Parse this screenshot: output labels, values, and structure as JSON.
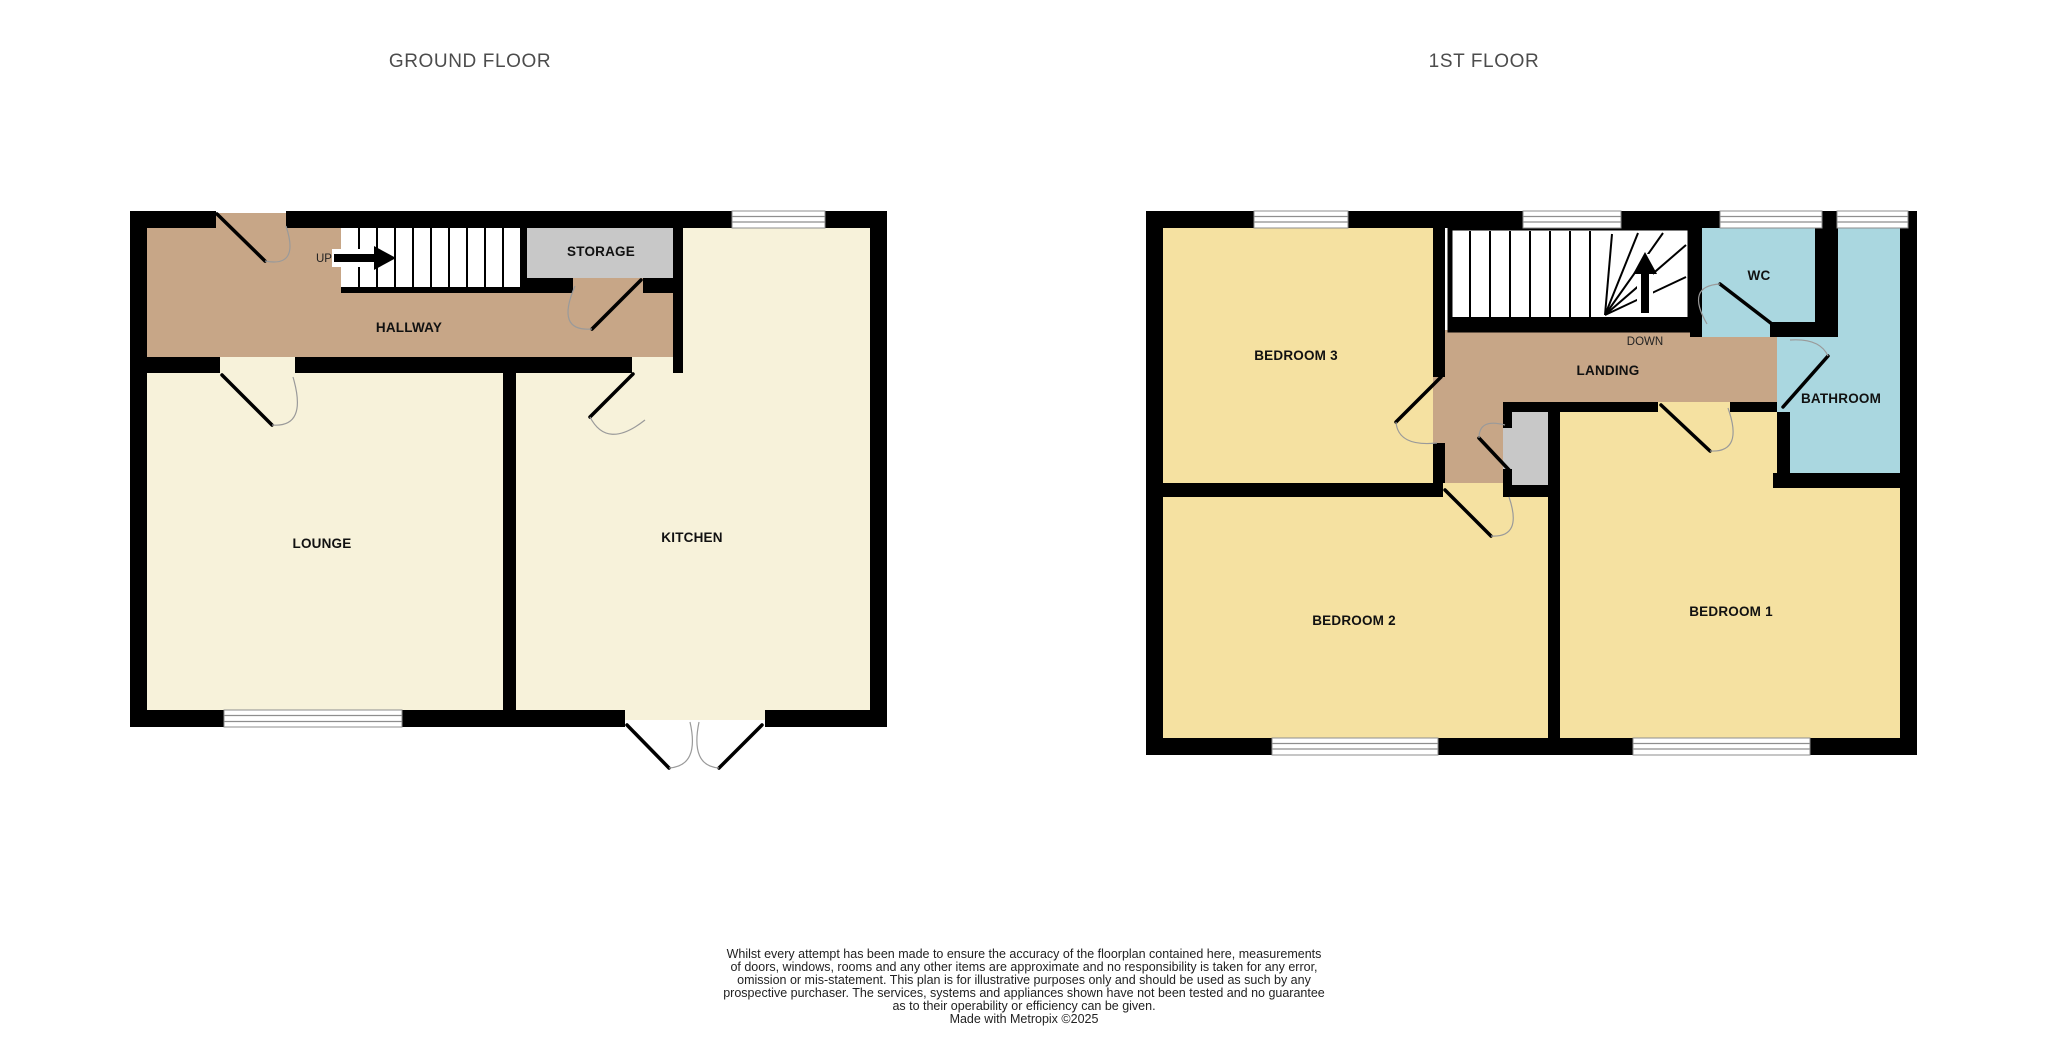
{
  "floors": [
    {
      "title": "GROUND FLOOR",
      "stair_direction_label": "UP",
      "rooms": [
        {
          "label": "HALLWAY"
        },
        {
          "label": "STORAGE"
        },
        {
          "label": "LOUNGE"
        },
        {
          "label": "KITCHEN"
        }
      ]
    },
    {
      "title": "1ST FLOOR",
      "stair_direction_label": "DOWN",
      "rooms": [
        {
          "label": "BEDROOM 3"
        },
        {
          "label": "LANDING"
        },
        {
          "label": "WC"
        },
        {
          "label": "BATHROOM"
        },
        {
          "label": "BEDROOM 2"
        },
        {
          "label": "BEDROOM 1"
        }
      ]
    }
  ],
  "disclaimer": {
    "lines": [
      "Whilst every attempt has been made to ensure the accuracy of the floorplan contained here, measurements",
      "of doors, windows, rooms and any other items are approximate and no responsibility is taken for any error,",
      "omission or mis-statement. This plan is for illustrative purposes only and should be used as such by any",
      "prospective purchaser. The services, systems and appliances shown have not been tested and no guarantee",
      "as to their operability or efficiency can be given.",
      "Made with Metropix ©2025"
    ]
  },
  "colors": {
    "wall": "#000000",
    "hallway_landing": "#c7a687",
    "lounge_kitchen": "#f7f2da",
    "bedroom": "#f5e1a1",
    "bathroom_wc": "#aad7e0",
    "storage_cupboard": "#c8c8c8",
    "title_text": "#4c4c4c",
    "window_line": "#8e8e8e"
  }
}
